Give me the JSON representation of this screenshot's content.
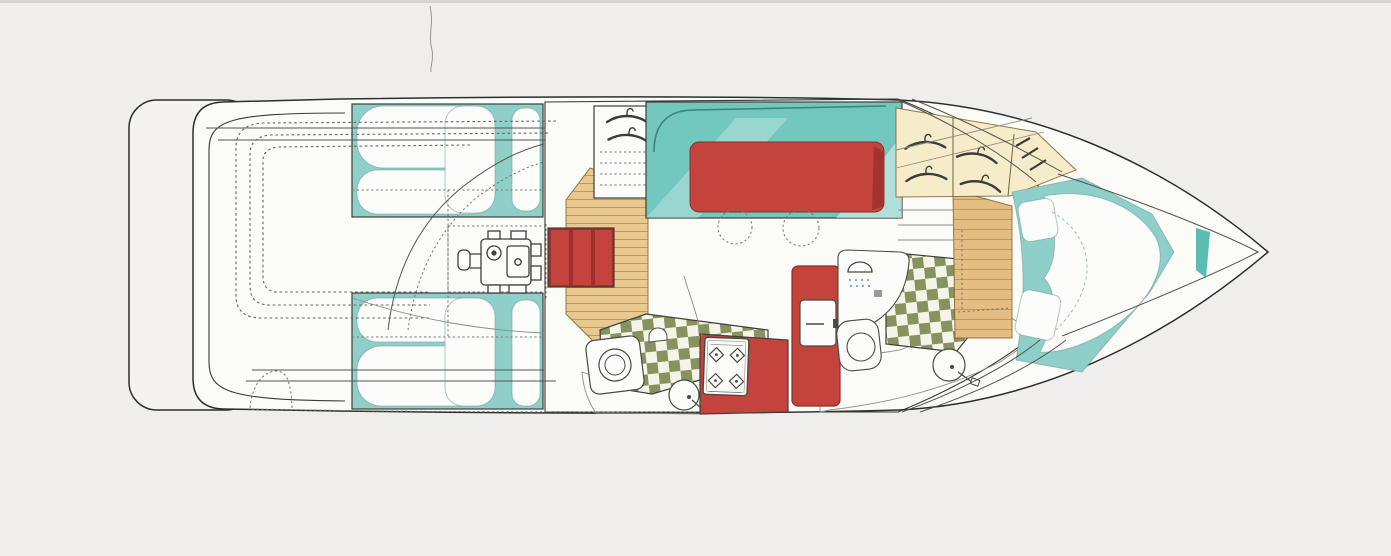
{
  "figure": {
    "kind": "yacht-interior-floorplan-top-view",
    "orientation": "bow-right-stern-left"
  },
  "components": [
    "swim-platform",
    "transom",
    "cockpit-settee",
    "cockpit-bench",
    "aft-cabin-berth-port",
    "aft-cabin-berth-starboard",
    "engine-compartment",
    "companionway-steps",
    "companionway-cabinet",
    "hanging-locker",
    "salon-dinette-settee",
    "dinette-table",
    "stool",
    "stool",
    "galley-counter",
    "galley-sink",
    "galley-basin",
    "galley-stove",
    "head-door",
    "shower-stall",
    "head-floor",
    "toilet",
    "vanity-sink",
    "forward-wardrobe",
    "forward-step-cabinet",
    "v-berth",
    "bow"
  ],
  "colors": {
    "background": "#efeeec",
    "scanEdge": "#cfcecb",
    "deck": "#fbfbf8",
    "platform": "#f4f3f0",
    "wood": "#eed7a6",
    "cabinetWood": "#e9c98f",
    "stepWood": "#e3bd82",
    "teal": "#8ed0c9",
    "tealDeep": "#72c7be",
    "tealDark": "#5bbcb2",
    "red": "#c5433d",
    "redDark": "#9e302c",
    "cream": "#f6ecca",
    "olive": "#87935f",
    "checkerBg": "#f5f4e9",
    "blueDeep": "#88accd",
    "blueLight": "#e9f1f7",
    "stoolYellowGreen": "#d9eab6",
    "stoolGreen": "#9ed2b5",
    "stoolTealLight": "#cde9db",
    "stoolTeal": "#a9d9c8",
    "white": "#fcfdfb"
  }
}
